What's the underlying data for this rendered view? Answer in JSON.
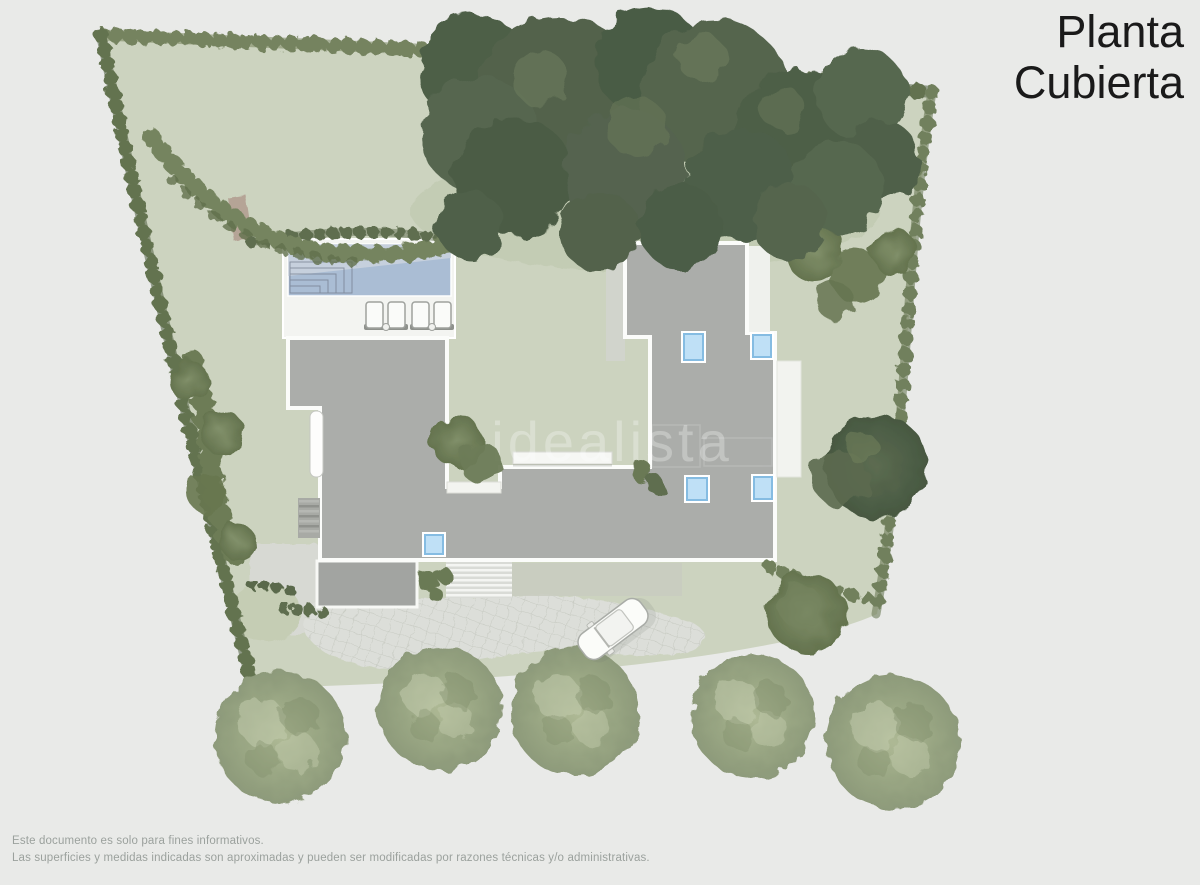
{
  "title": {
    "line1": "Planta",
    "line2": "Cubierta"
  },
  "watermark": {
    "text": "idealista"
  },
  "footer": {
    "line1": "Este documento es solo para fines informativos.",
    "line2": "Las superficies y medidas indicadas son aproximadas y pueden ser modificadas por razones técnicas y/o administrativas."
  },
  "plan": {
    "type": "roof-plan",
    "skylight_count": 5,
    "sun_lounger_count": 4,
    "bottom_tree_count": 5,
    "car_count": 1
  },
  "colors": {
    "background": "#e9eae8",
    "lawn": "#ccd3bf",
    "lawn_shade": "#bfc9ad",
    "roof": "#abadaa",
    "roof_border": "#fbfcfa",
    "annex_roof": "#a2a4a1",
    "deck": "#f3f4f1",
    "pool_water": "#aabdd4",
    "pool_water_light": "#cdd5de",
    "skylight_fill": "#bfe0f6",
    "skylight_border": "#85bce2",
    "driveway": "#dcded9",
    "gravel": "#d7d9d3",
    "path_tan": "#b5a496",
    "hedge_dark": "#5d6c50",
    "hedge_medium": "#72815e",
    "tree_dark": "#4e5f47",
    "tree_pale": "#97a482",
    "title_text": "#1a1a1a",
    "footer_text": "#9ba19d"
  }
}
